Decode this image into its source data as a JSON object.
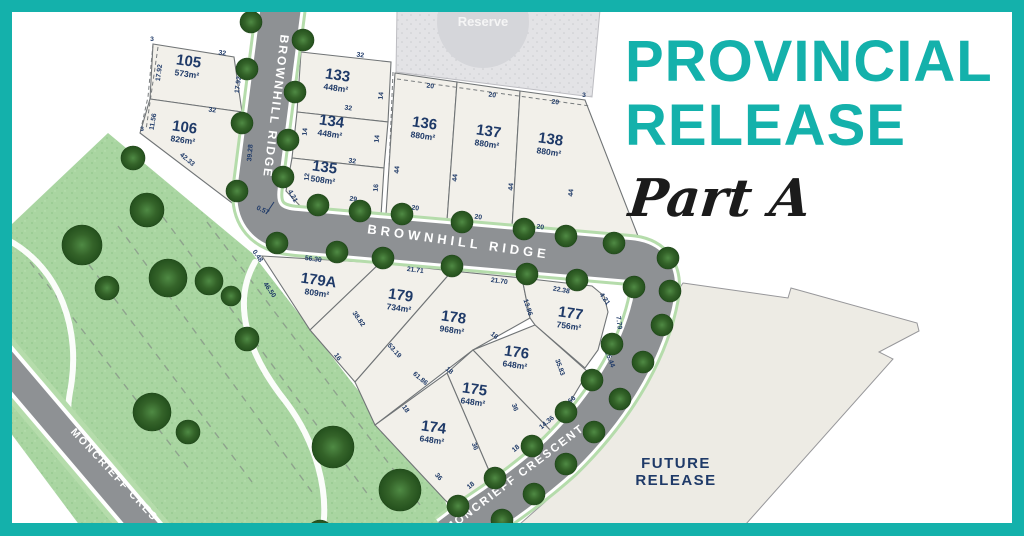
{
  "frame": {
    "color": "#14b1ab",
    "bg": "#ffffff"
  },
  "title": {
    "line1": "PROVINCIAL",
    "line2": "RELEASE",
    "subtitle": "Part A",
    "title_color": "#14b1ab",
    "subtitle_color": "#1b1b1b"
  },
  "palette": {
    "navy": "#1f3a68",
    "road": "#8e9194",
    "verge": "#b5dcab",
    "white_line": "#ffffff",
    "park": "#a9d5a1",
    "park_dot": "#93c78c",
    "park_dot2": "#bce3b4",
    "lot_fill": "#f2f0ea",
    "lot_stroke": "#707476",
    "reserve_fill": "#e3e3e6",
    "reserve_dot": "#cbccd0",
    "reserve_circle": "#d5d6da",
    "future_fill": "#edebe4",
    "future_stroke": "#97979a",
    "tree_light": "#4f8a44",
    "tree_mid": "#346329",
    "tree_dark": "#24501d",
    "dash_color": "#8a9b8a",
    "path_white": "#ffffff"
  },
  "park": {
    "outline": [
      [
        108,
        133
      ],
      [
        252,
        253
      ],
      [
        350,
        380
      ],
      [
        445,
        500
      ],
      [
        452,
        524
      ],
      [
        170,
        524
      ],
      [
        12,
        340
      ],
      [
        12,
        224
      ]
    ],
    "strip": [
      [
        -2,
        385
      ],
      [
        128,
        542
      ],
      [
        92,
        542
      ],
      [
        -2,
        416
      ]
    ],
    "paths": [
      "M 8,240 C 60,268 82,330 70,392 C 60,448 92,502 128,534",
      "M 255,262 C 232,302 246,352 286,402 C 316,442 330,492 322,534"
    ],
    "dashes": [
      [
        30,
        262,
        190,
        470
      ],
      [
        72,
        242,
        252,
        482
      ],
      [
        118,
        226,
        312,
        492
      ],
      [
        163,
        217,
        372,
        500
      ],
      [
        207,
        222,
        420,
        505
      ]
    ]
  },
  "reserve": {
    "label": "Reserve",
    "poly": [
      [
        397,
        10
      ],
      [
        600,
        10
      ],
      [
        592,
        97
      ],
      [
        396,
        72
      ]
    ],
    "circle": [
      483,
      22,
      46
    ],
    "label_pos": [
      483,
      26
    ]
  },
  "future": {
    "label1": "FUTURE",
    "label2": "RELEASE",
    "poly": [
      [
        683,
        283
      ],
      [
        788,
        298
      ],
      [
        791,
        288
      ],
      [
        917,
        323
      ],
      [
        919,
        331
      ],
      [
        879,
        352
      ],
      [
        893,
        359
      ],
      [
        746,
        524
      ],
      [
        520,
        524
      ],
      [
        545,
        502
      ],
      [
        590,
        458
      ],
      [
        628,
        408
      ],
      [
        655,
        358
      ],
      [
        668,
        305
      ]
    ],
    "label_pos": [
      676,
      468
    ]
  },
  "roads": [
    {
      "name": "road-brownhill",
      "d": "M 281,6 L 258,185 Q 252,228 297,231 L 630,260 Q 660,263 654,296 C 645,345 615,402 560,456 Q 520,492 466,526 L 450,538",
      "w_verge": 52,
      "w_edge": 46,
      "w_road": 40
    },
    {
      "name": "road-moncrieff-west",
      "d": "M -8,348 L 162,548",
      "w_verge": 44,
      "w_edge": 34,
      "w_road": 26
    }
  ],
  "streets": [
    {
      "label": "BROWNHILL RIDGE",
      "x": 272,
      "y": 106,
      "rotate": 97,
      "size": 12,
      "ls": 2
    },
    {
      "label": "BROWNHILL RIDGE",
      "x": 458,
      "y": 246,
      "rotate": 8,
      "size": 13,
      "ls": 4
    },
    {
      "label": "MONCRIEFF CRESCENT",
      "x": 517,
      "y": 481,
      "rotate": -37,
      "size": 11.5,
      "ls": 2
    },
    {
      "label": "MONCRIEFF CRES",
      "x": 112,
      "y": 477,
      "rotate": 47,
      "size": 10.5,
      "ls": 2
    }
  ],
  "lots": [
    {
      "id": "105",
      "area": "573m²",
      "label": [
        188,
        66
      ],
      "rotate": 8,
      "poly": [
        [
          153,
          44
        ],
        [
          234,
          57
        ],
        [
          242,
          112
        ],
        [
          150,
          99
        ]
      ]
    },
    {
      "id": "106",
      "area": "826m²",
      "label": [
        184,
        132
      ],
      "rotate": 8,
      "poly": [
        [
          150,
          99
        ],
        [
          242,
          112
        ],
        [
          246,
          190
        ],
        [
          236,
          206
        ],
        [
          140,
          133
        ]
      ]
    },
    {
      "id": "133",
      "area": "448m²",
      "label": [
        337,
        80
      ],
      "rotate": 8,
      "poly": [
        [
          301,
          52
        ],
        [
          391,
          62
        ],
        [
          388,
          122
        ],
        [
          297,
          112
        ]
      ]
    },
    {
      "id": "134",
      "area": "448m²",
      "label": [
        331,
        126
      ],
      "rotate": 8,
      "poly": [
        [
          297,
          112
        ],
        [
          388,
          122
        ],
        [
          384,
          168
        ],
        [
          292,
          158
        ]
      ]
    },
    {
      "id": "135",
      "area": "508m²",
      "label": [
        324,
        172
      ],
      "rotate": 8,
      "poly": [
        [
          292,
          158
        ],
        [
          384,
          168
        ],
        [
          381,
          216
        ],
        [
          302,
          208
        ],
        [
          286,
          191
        ]
      ]
    },
    {
      "id": "136",
      "area": "880m²",
      "label": [
        424,
        128
      ],
      "rotate": 8,
      "poly": [
        [
          395,
          73
        ],
        [
          457,
          82
        ],
        [
          447,
          221
        ],
        [
          386,
          214
        ]
      ]
    },
    {
      "id": "137",
      "area": "880m²",
      "label": [
        488,
        136
      ],
      "rotate": 8,
      "poly": [
        [
          457,
          82
        ],
        [
          520,
          91
        ],
        [
          512,
          228
        ],
        [
          447,
          221
        ]
      ]
    },
    {
      "id": "138",
      "area": "880m²",
      "label": [
        550,
        144
      ],
      "rotate": 8,
      "poly": [
        [
          520,
          91
        ],
        [
          585,
          100
        ],
        [
          638,
          236
        ],
        [
          512,
          228
        ]
      ]
    },
    {
      "id": "179A",
      "area": "809m²",
      "label": [
        318,
        285
      ],
      "rotate": 8,
      "poly": [
        [
          262,
          256
        ],
        [
          380,
          263
        ],
        [
          310,
          330
        ]
      ]
    },
    {
      "id": "179",
      "area": "734m²",
      "label": [
        400,
        300
      ],
      "rotate": 8,
      "poly": [
        [
          380,
          263
        ],
        [
          452,
          271
        ],
        [
          355,
          382
        ],
        [
          310,
          330
        ]
      ]
    },
    {
      "id": "178",
      "area": "968m²",
      "label": [
        453,
        322
      ],
      "rotate": 8,
      "poly": [
        [
          452,
          271
        ],
        [
          522,
          278
        ],
        [
          530,
          318
        ],
        [
          473,
          350
        ],
        [
          375,
          425
        ],
        [
          355,
          382
        ]
      ]
    },
    {
      "id": "177",
      "area": "756m²",
      "label": [
        570,
        318
      ],
      "rotate": 8,
      "poly": [
        [
          522,
          278
        ],
        [
          592,
          286
        ],
        [
          604,
          296
        ],
        [
          608,
          312
        ],
        [
          598,
          350
        ],
        [
          585,
          368
        ],
        [
          535,
          325
        ],
        [
          530,
          318
        ]
      ]
    },
    {
      "id": "176",
      "area": "648m²",
      "label": [
        516,
        357
      ],
      "rotate": 8,
      "poly": [
        [
          535,
          325
        ],
        [
          588,
          372
        ],
        [
          552,
          432
        ],
        [
          473,
          350
        ]
      ]
    },
    {
      "id": "175",
      "area": "648m²",
      "label": [
        474,
        394
      ],
      "rotate": 8,
      "poly": [
        [
          447,
          373
        ],
        [
          473,
          350
        ],
        [
          552,
          432
        ],
        [
          493,
          480
        ]
      ]
    },
    {
      "id": "174",
      "area": "648m²",
      "label": [
        433,
        432
      ],
      "rotate": 8,
      "poly": [
        [
          375,
          425
        ],
        [
          447,
          373
        ],
        [
          493,
          480
        ],
        [
          459,
          513
        ],
        [
          445,
          500
        ]
      ]
    }
  ],
  "dashed_lines": [
    {
      "pts": [
        [
          158,
          47
        ],
        [
          146,
          130
        ]
      ]
    },
    {
      "pts": [
        [
          153,
          44
        ],
        [
          148,
          97
        ],
        [
          140,
          133
        ]
      ]
    },
    {
      "pts": [
        [
          397,
          79
        ],
        [
          590,
          106
        ]
      ]
    },
    {
      "pts": [
        [
          393,
          72
        ],
        [
          389,
          168
        ]
      ]
    }
  ],
  "dims": [
    [
      "3",
      152,
      41,
      0
    ],
    [
      "32",
      222,
      55,
      8
    ],
    [
      "17.92",
      161,
      73,
      -82
    ],
    [
      "17.92",
      240,
      85,
      -82
    ],
    [
      "32",
      212,
      112,
      8
    ],
    [
      "11.56",
      155,
      122,
      -80
    ],
    [
      "3",
      142,
      131,
      0
    ],
    [
      "39.28",
      252,
      153,
      -85
    ],
    [
      "42.33",
      186,
      161,
      40
    ],
    [
      "0.57",
      262,
      212,
      25
    ],
    [
      "32",
      360,
      57,
      8
    ],
    [
      "14",
      305,
      90,
      -85
    ],
    [
      "14",
      383,
      96,
      -85
    ],
    [
      "32",
      348,
      110,
      8
    ],
    [
      "14",
      307,
      132,
      -85
    ],
    [
      "14",
      379,
      139,
      -85
    ],
    [
      "32",
      352,
      163,
      8
    ],
    [
      "12",
      309,
      177,
      -85
    ],
    [
      "16",
      378,
      188,
      -85
    ],
    [
      "29",
      353,
      201,
      8
    ],
    [
      "4.21",
      291,
      197,
      60
    ],
    [
      "20",
      430,
      88,
      8
    ],
    [
      "20",
      492,
      97,
      8
    ],
    [
      "20",
      555,
      104,
      8
    ],
    [
      "3",
      584,
      97,
      0
    ],
    [
      "44",
      399,
      170,
      -85
    ],
    [
      "44",
      457,
      178,
      -85
    ],
    [
      "44",
      513,
      187,
      -85
    ],
    [
      "44",
      573,
      193,
      -85
    ],
    [
      "20",
      415,
      210,
      8
    ],
    [
      "20",
      478,
      219,
      8
    ],
    [
      "20",
      540,
      229,
      8
    ],
    [
      "0.48",
      256,
      257,
      55
    ],
    [
      "46.50",
      268,
      291,
      55
    ],
    [
      "56.30",
      313,
      261,
      8
    ],
    [
      "21.71",
      415,
      272,
      8
    ],
    [
      "21.70",
      499,
      283,
      8
    ],
    [
      "22.38",
      561,
      292,
      10
    ],
    [
      "4.21",
      603,
      300,
      55
    ],
    [
      "7.79",
      617,
      323,
      83
    ],
    [
      "25.44",
      608,
      360,
      68
    ],
    [
      "3.66",
      571,
      403,
      -40
    ],
    [
      "14.36",
      548,
      424,
      -40
    ],
    [
      "18",
      517,
      450,
      -40
    ],
    [
      "18",
      472,
      487,
      -40
    ],
    [
      "36",
      437,
      478,
      50
    ],
    [
      "36",
      473,
      447,
      70
    ],
    [
      "36",
      513,
      408,
      70
    ],
    [
      "35.83",
      558,
      368,
      70
    ],
    [
      "13.86",
      526,
      308,
      72
    ],
    [
      "18",
      493,
      337,
      40
    ],
    [
      "61.86",
      419,
      380,
      40
    ],
    [
      "18",
      448,
      372,
      40
    ],
    [
      "53.19",
      393,
      352,
      48
    ],
    [
      "38.82",
      357,
      320,
      55
    ],
    [
      "16",
      336,
      358,
      55
    ],
    [
      "18",
      404,
      410,
      55
    ]
  ],
  "trees": [
    [
      251,
      22
    ],
    [
      247,
      69
    ],
    [
      242,
      123
    ],
    [
      237,
      191
    ],
    [
      303,
      40
    ],
    [
      295,
      92
    ],
    [
      288,
      140
    ],
    [
      283,
      177
    ],
    [
      318,
      205
    ],
    [
      360,
      211
    ],
    [
      402,
      214
    ],
    [
      462,
      222
    ],
    [
      524,
      229
    ],
    [
      566,
      236
    ],
    [
      614,
      243
    ],
    [
      277,
      243
    ],
    [
      337,
      252
    ],
    [
      383,
      258
    ],
    [
      452,
      266
    ],
    [
      527,
      274
    ],
    [
      577,
      280
    ],
    [
      634,
      287
    ],
    [
      612,
      344
    ],
    [
      592,
      380
    ],
    [
      566,
      412
    ],
    [
      532,
      446
    ],
    [
      495,
      478
    ],
    [
      458,
      506
    ],
    [
      668,
      258
    ],
    [
      670,
      291
    ],
    [
      662,
      325
    ],
    [
      643,
      362
    ],
    [
      620,
      399
    ],
    [
      594,
      432
    ],
    [
      566,
      464
    ],
    [
      534,
      494
    ],
    [
      502,
      520
    ],
    [
      133,
      158,
      12
    ],
    [
      147,
      210,
      17
    ],
    [
      82,
      245,
      20
    ],
    [
      168,
      278,
      19
    ],
    [
      209,
      281,
      14
    ],
    [
      107,
      288,
      12
    ],
    [
      231,
      296,
      10
    ],
    [
      247,
      339,
      12
    ],
    [
      152,
      412,
      19
    ],
    [
      188,
      432,
      12
    ],
    [
      333,
      447,
      21
    ],
    [
      400,
      490,
      21
    ],
    [
      320,
      533,
      13
    ]
  ],
  "arrow": [
    266,
    214,
    274,
    202
  ]
}
